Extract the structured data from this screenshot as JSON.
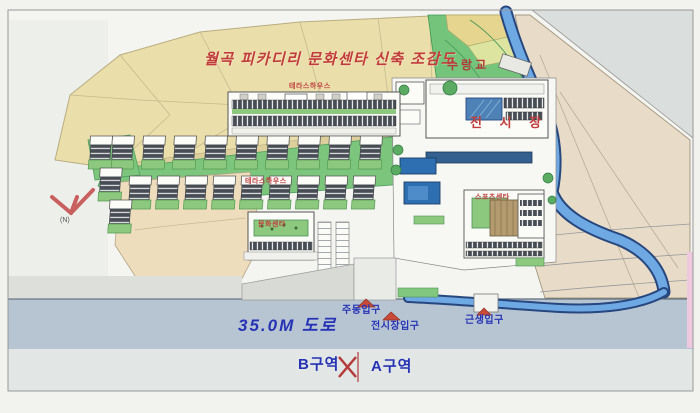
{
  "title": {
    "text": "월곡 피카디리 문화센타 신축 조감도"
  },
  "map_labels": {
    "bridge": "수랑교",
    "exhibition_hall": "전 시 장",
    "terrace_upper": "테라스하우스",
    "terrace_lower": "테라스하우스",
    "culture_center": "문화센타",
    "sports_center": "스포츠센타",
    "north_mark": "(N)"
  },
  "road_labels": {
    "road": "35.0M 도로",
    "entrance_main": "주동입구",
    "entrance_exhibition": "전시장입구",
    "entrance_retail": "근생입구"
  },
  "zones": {
    "b": "B구역",
    "a": "A구역"
  },
  "colors": {
    "title_red": "#c23b3b",
    "label_blue": "#2633b5",
    "river_blue": "#6fa9e4",
    "terrain_tan": "#eadfab",
    "vegetation_green": "#77c47d",
    "road_gray": "#b7c5d3",
    "pool_blue": "#2e6fb2"
  }
}
